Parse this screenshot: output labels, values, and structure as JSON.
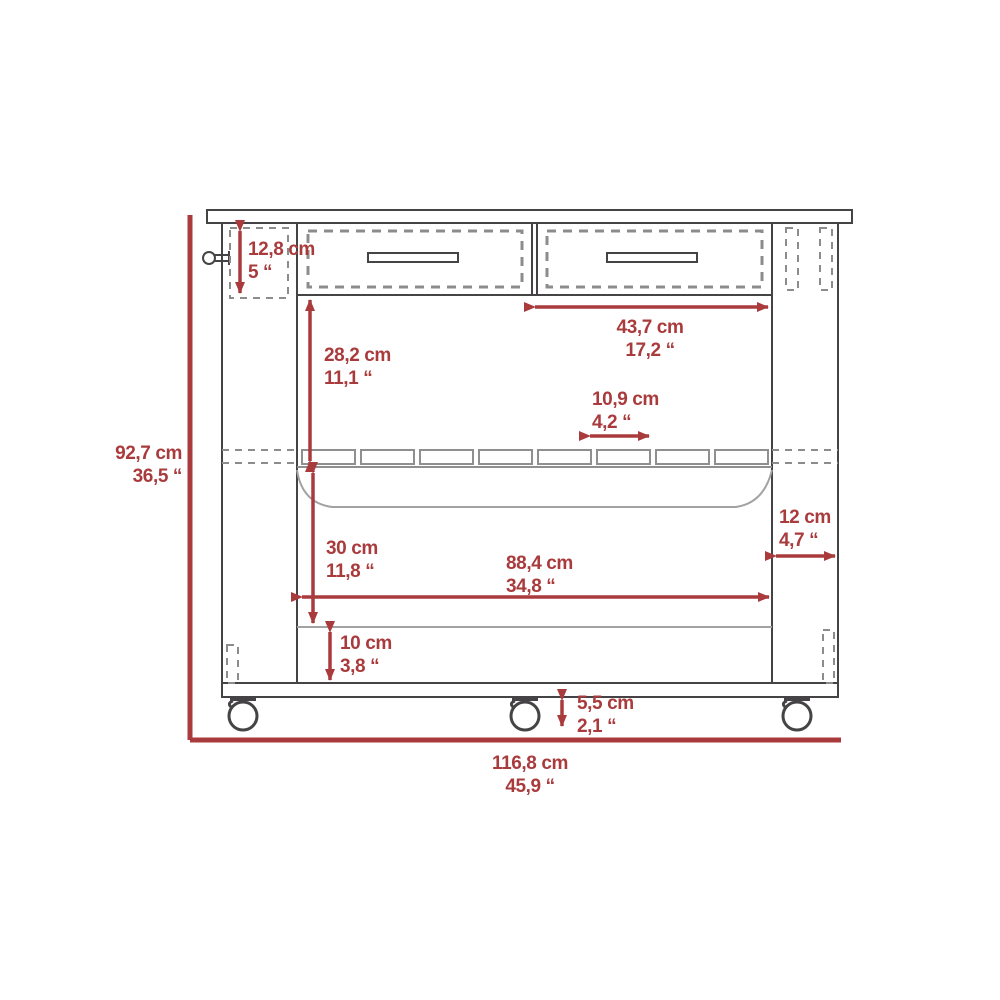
{
  "colors": {
    "dimension_red": "#a93b3d",
    "line_dark": "#454345",
    "line_mid": "#8c8c8c",
    "line_light": "#a2a2a2"
  },
  "dimensions": {
    "overall_height": {
      "cm": "92,7 cm",
      "inch": "36,5 “"
    },
    "overall_width": {
      "cm": "116,8 cm",
      "inch": "45,9 “"
    },
    "drawer_height": {
      "cm": "12,8 cm",
      "inch": "5 “"
    },
    "drawer_width": {
      "cm": "43,7  cm",
      "inch": "17,2 “"
    },
    "top_to_rack": {
      "cm": "28,2 cm",
      "inch": "11,1 “"
    },
    "slat_width": {
      "cm": "10,9 cm",
      "inch": "4,2 “"
    },
    "side_depth": {
      "cm": "12  cm",
      "inch": "4,7 “"
    },
    "shelf_height": {
      "cm": "30 cm",
      "inch": "11,8 “"
    },
    "inner_width": {
      "cm": "88,4  cm",
      "inch": "34,8 “"
    },
    "base_height": {
      "cm": "10 cm",
      "inch": "3,8 “"
    },
    "caster_height": {
      "cm": "5,5 cm",
      "inch": "2,1 “"
    }
  }
}
